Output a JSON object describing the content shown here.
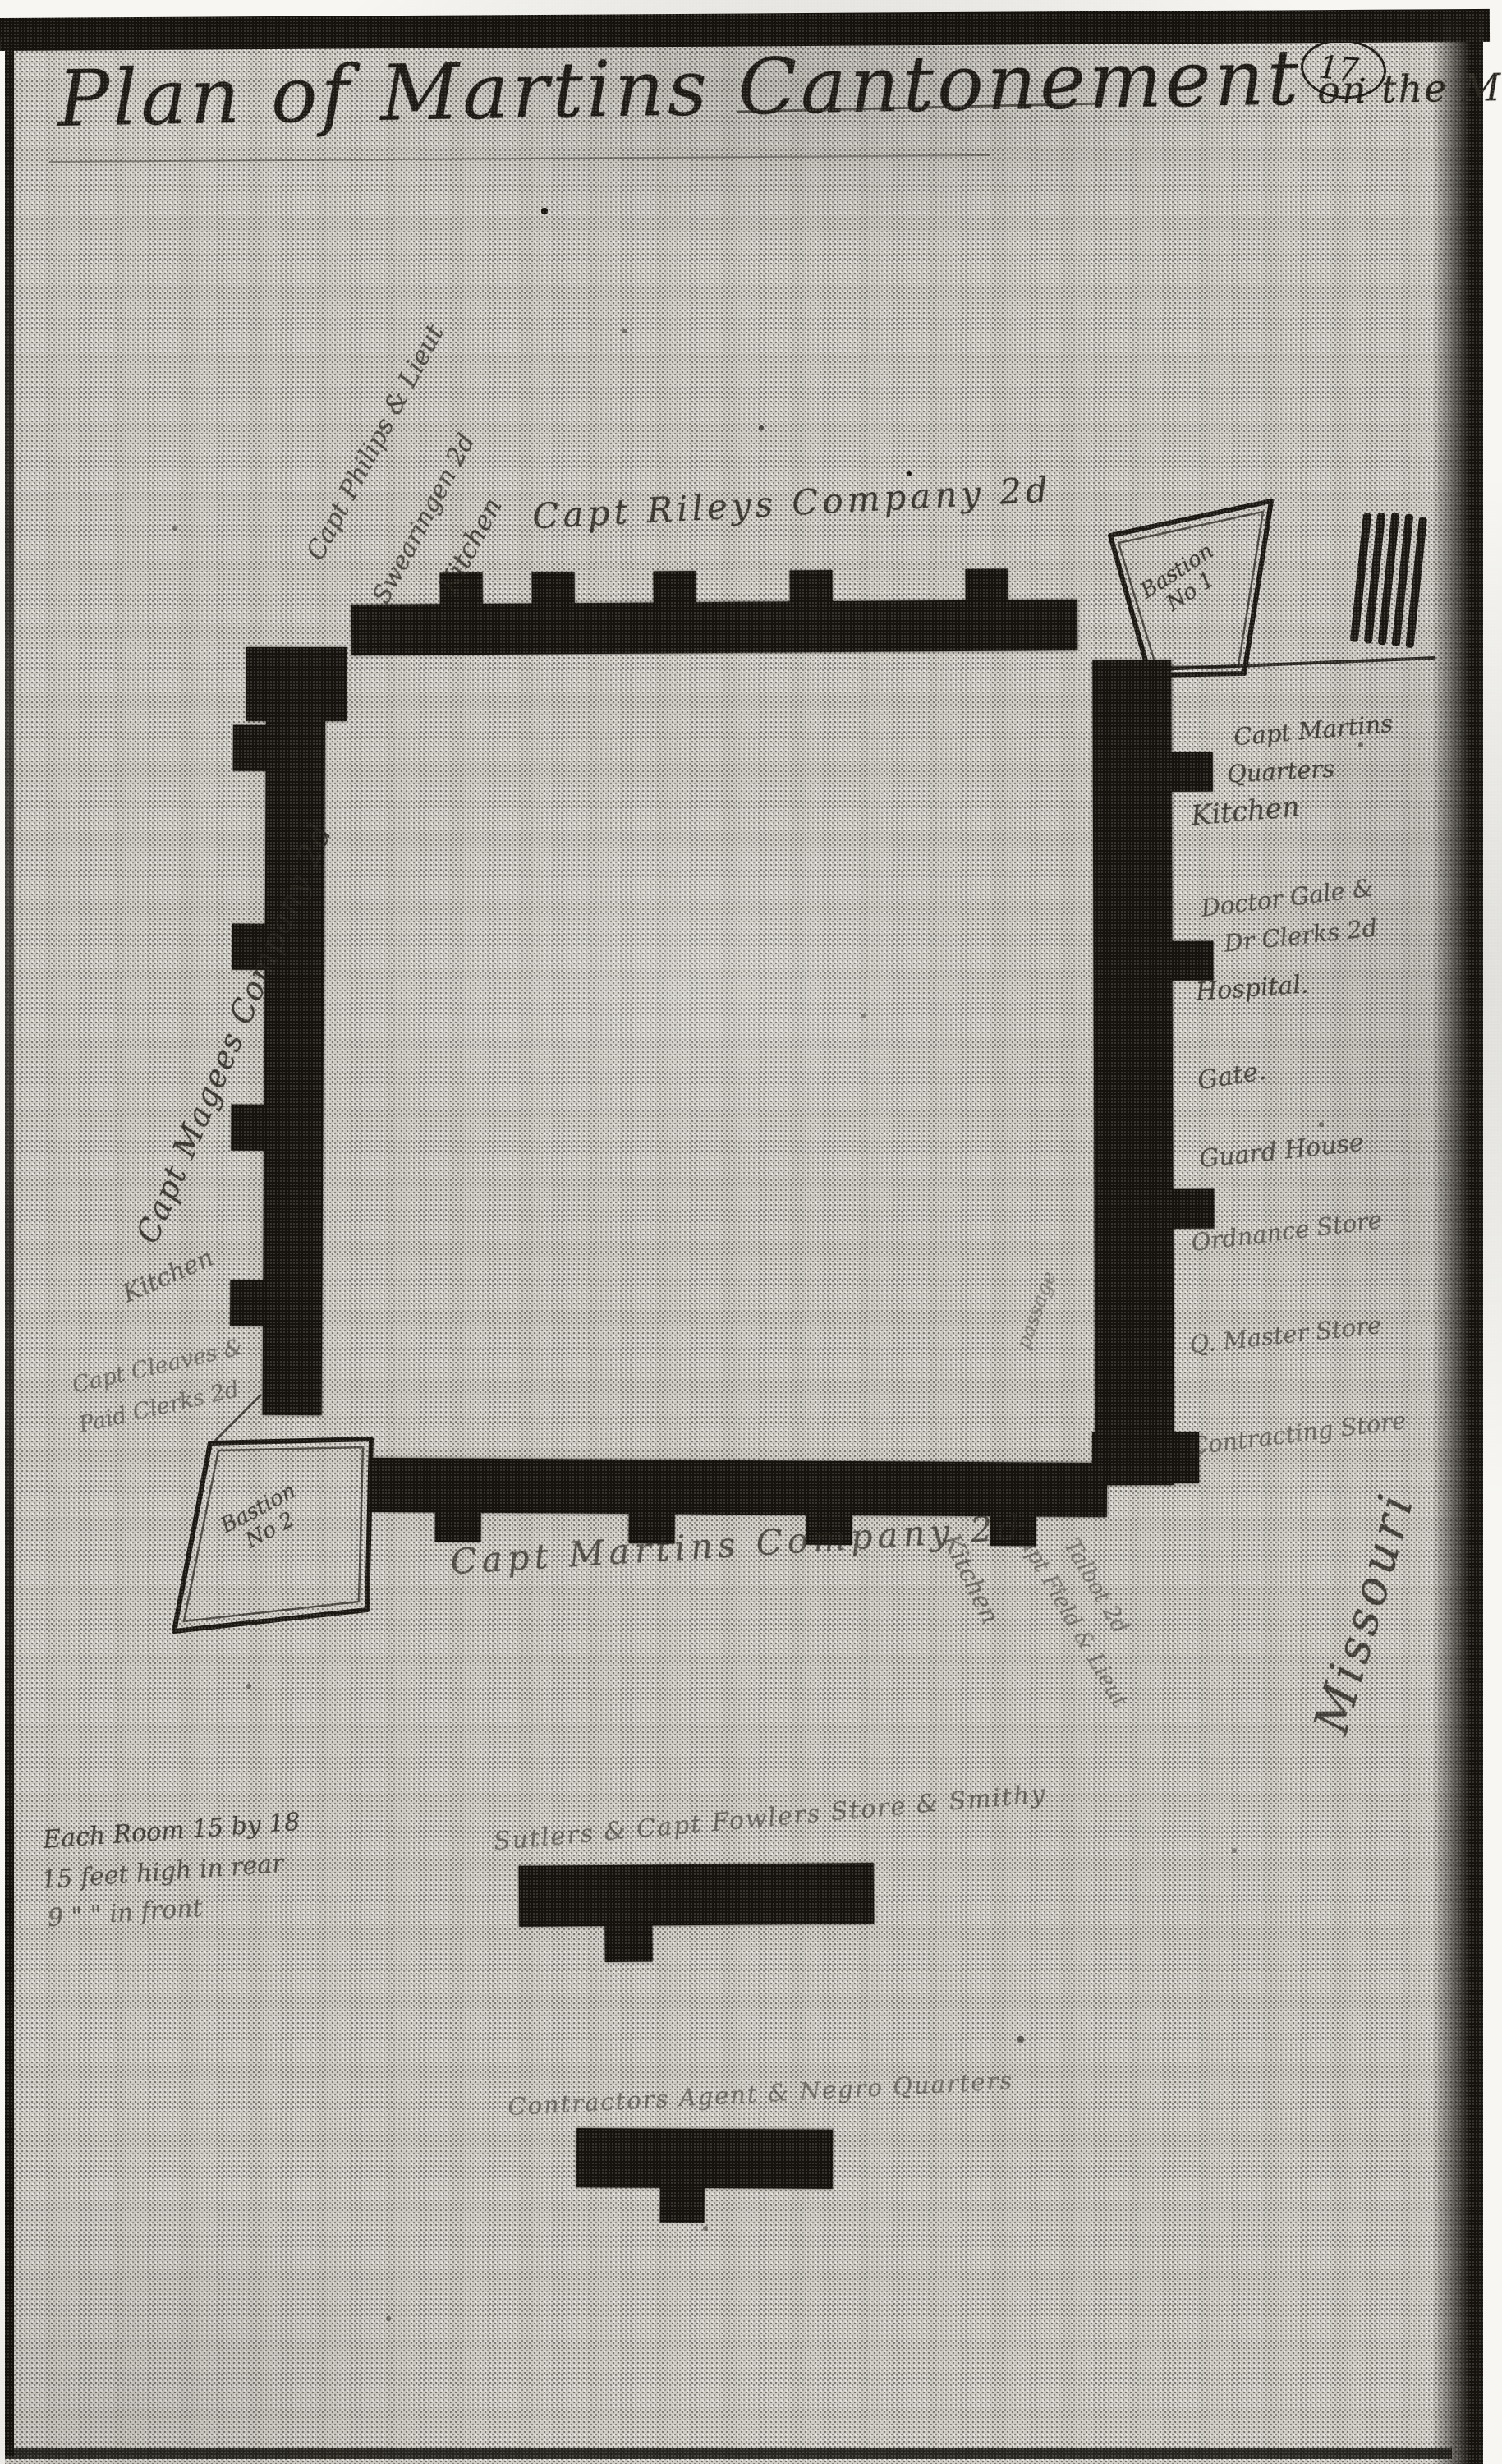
{
  "document": {
    "title_main": "Plan of Martins Cantonement",
    "title_suffix": "on the Missouri",
    "page_number": "17.",
    "margin_label": "Missouri"
  },
  "fort": {
    "north": {
      "company_label": "Capt Rileys Company 2d",
      "officer_label_1": "Capt Philips & Lieut",
      "officer_label_2": "Swearingen 2d",
      "kitchen_label": "Kitchen"
    },
    "west": {
      "company_label": "Capt Magees Company 2d",
      "kitchen_label": "Kitchen",
      "officer_label_1": "Capt Cleaves &",
      "officer_label_2": "Paid Clerks 2d"
    },
    "south": {
      "company_label": "Capt Martins Company 2d",
      "kitchen_label": "Kitchen",
      "officer_label_1": "Capt Field & Lieut",
      "officer_label_2": "Talbot 2d"
    },
    "east": {
      "labels": [
        "Capt Martins",
        "Quarters",
        "Kitchen",
        "Doctor Gale &",
        "Dr Clerks 2d",
        "Hospital.",
        "Gate.",
        "Guard House",
        "Ordnance Store",
        "Q. Master Store",
        "Contracting Store"
      ],
      "inner_label": "passage"
    },
    "bastion_1": {
      "name_line": "Bastion",
      "number_line": "No 1"
    },
    "bastion_2": {
      "name_line": "Bastion",
      "number_line": "No 2"
    }
  },
  "outbuildings": {
    "sutlers_label": "Sutlers & Capt Fowlers Store & Smithy",
    "contractors_label": "Contractors Agent & Negro Quarters"
  },
  "notes": {
    "line1": "Each Room 15 by 18",
    "line2": "15 feet high in rear",
    "line3": "9 \" \" in front"
  },
  "colors": {
    "ink": "#16130e",
    "paper": "#cfccc5"
  }
}
